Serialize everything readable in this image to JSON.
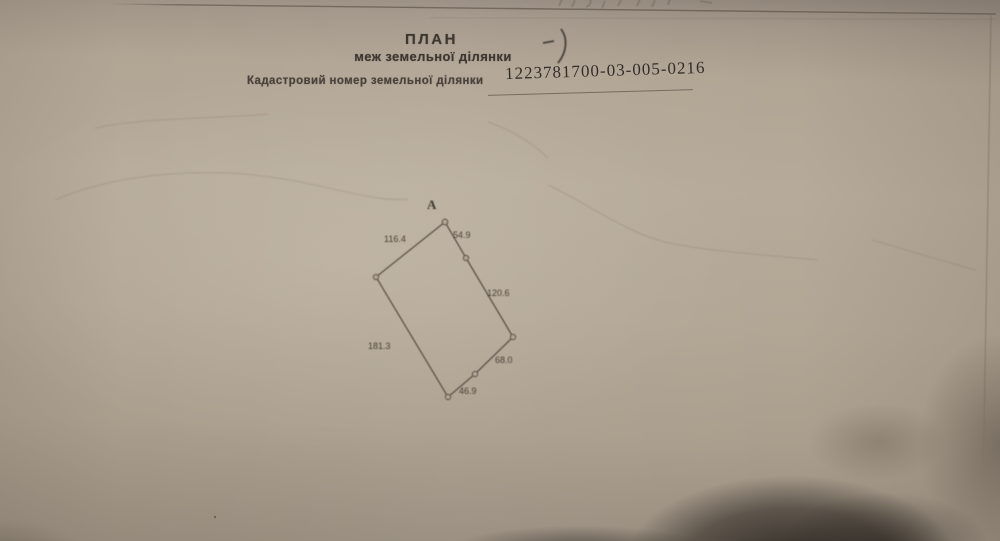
{
  "document": {
    "title": "ПЛАН",
    "subtitle": "меж земельної ділянки",
    "cadastral": {
      "label": "Кадастровий номер земельної ділянки",
      "number": "1223781700-03-005-0216"
    }
  },
  "plot": {
    "point_label": "А",
    "edge_lengths": {
      "top_left": "116.4",
      "top_right": "54.9",
      "right": "120.6",
      "lower_right": "68.0",
      "bottom": "46.9",
      "left": "181.3"
    }
  },
  "colors": {
    "paper": "#b2a695",
    "ink": "#3e372f",
    "drawing_line": "#5d5348"
  }
}
